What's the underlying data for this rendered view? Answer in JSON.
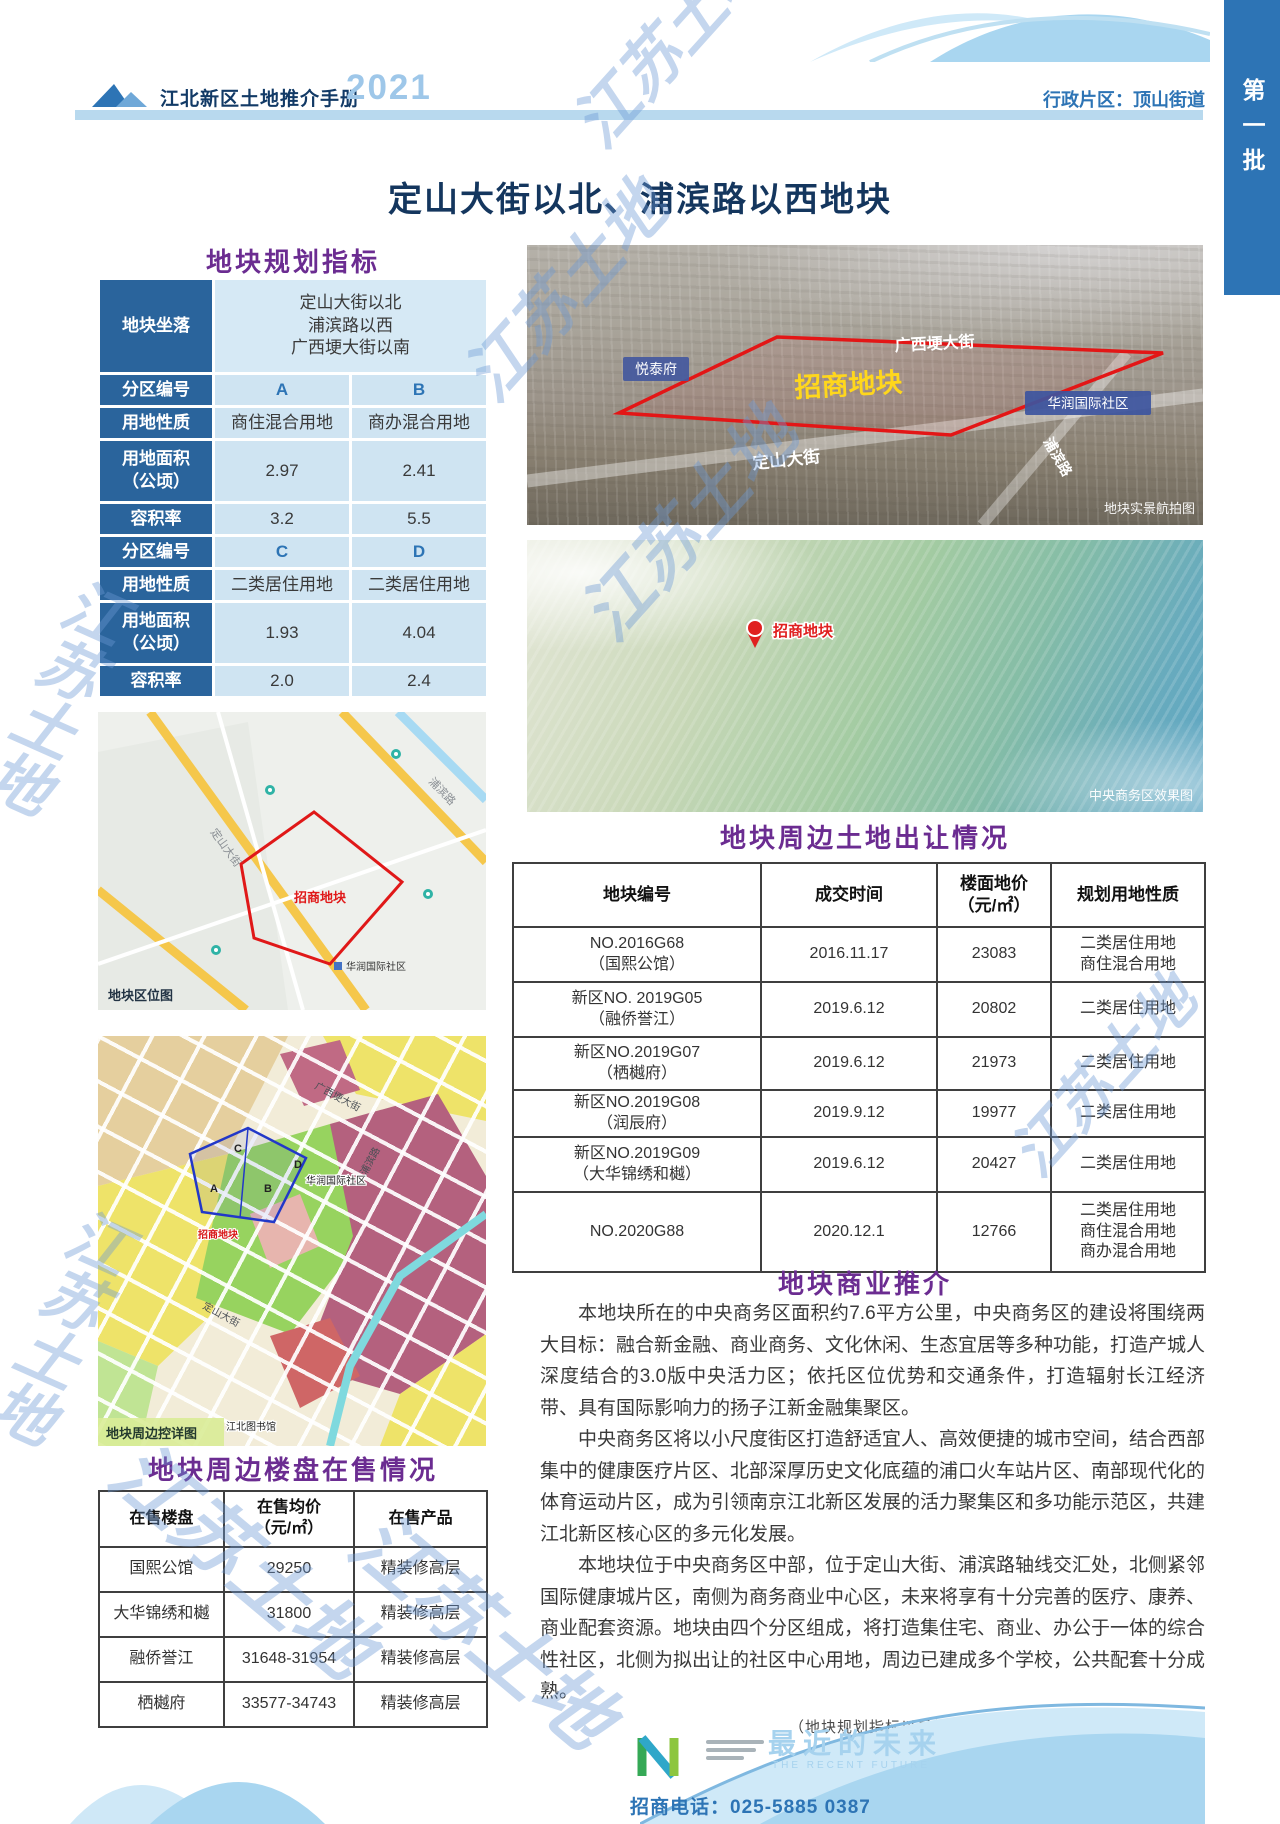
{
  "header": {
    "handbook_title": "江北新区土地推介手册",
    "year": "2021",
    "district_label": "行政片区：顶山街道",
    "batch_tab": "第一批"
  },
  "page_title": "定山大街以北、浦滨路以西地块",
  "watermark_text": "江苏土地",
  "colors": {
    "accent_blue": "#2d74b5",
    "title_purple": "#6b2c91",
    "table_header_blue": "#2a649c",
    "table_cell_blue": "#cfe4f2",
    "plot_outline_red": "#e01818"
  },
  "planning_table": {
    "title": "地块规划指标",
    "rows": [
      {
        "label": "地块坐落",
        "value": "定山大街以北\n浦滨路以西\n广西埂大街以南"
      },
      {
        "label": "分区编号",
        "a": "A",
        "b": "B"
      },
      {
        "label": "用地性质",
        "a": "商住混合用地",
        "b": "商办混合用地"
      },
      {
        "label": "用地面积\n（公顷）",
        "a": "2.97",
        "b": "2.41"
      },
      {
        "label": "容积率",
        "a": "3.2",
        "b": "5.5"
      },
      {
        "label": "分区编号",
        "a": "C",
        "b": "D"
      },
      {
        "label": "用地性质",
        "a": "二类居住用地",
        "b": "二类居住用地"
      },
      {
        "label": "用地面积\n（公顷）",
        "a": "1.93",
        "b": "4.04"
      },
      {
        "label": "容积率",
        "a": "2.0",
        "b": "2.4"
      }
    ]
  },
  "location_map": {
    "caption": "地块区位图",
    "plot_label": "招商地块",
    "labels": {
      "road1": "定山大街",
      "road2": "浦滨路",
      "community": "华润国际社区"
    }
  },
  "zoning_map": {
    "caption": "地块周边控详图",
    "plot_label": "招商地块",
    "zones": [
      "A",
      "B",
      "C",
      "D"
    ],
    "labels": {
      "road1": "广西埂大街",
      "road2": "浦滨路",
      "road3": "定山大街",
      "community": "华润国际社区",
      "library": "江北图书馆"
    }
  },
  "aerial_photo": {
    "caption": "地块实景航拍图",
    "plot_label": "招商地块",
    "labels": {
      "estate1": "悦泰府",
      "road1": "广西埂大街",
      "community": "华润国际社区",
      "road2": "定山大街",
      "road3": "浦滨路"
    }
  },
  "cbd_render": {
    "caption": "中央商务区效果图",
    "pin_label": "招商地块"
  },
  "land_sales_table": {
    "title": "地块周边土地出让情况",
    "headers": [
      "地块编号",
      "成交时间",
      "楼面地价\n（元/㎡）",
      "规划用地性质"
    ],
    "rows": [
      [
        "NO.2016G68\n（国熙公馆）",
        "2016.11.17",
        "23083",
        "二类居住用地\n商住混合用地"
      ],
      [
        "新区NO. 2019G05\n（融侨誉江）",
        "2019.6.12",
        "20802",
        "二类居住用地"
      ],
      [
        "新区NO.2019G07\n（栖樾府）",
        "2019.6.12",
        "21973",
        "二类居住用地"
      ],
      [
        "新区NO.2019G08\n（润辰府）",
        "2019.9.12",
        "19977",
        "二类居住用地"
      ],
      [
        "新区NO.2019G09\n（大华锦绣和樾）",
        "2019.6.12",
        "20427",
        "二类居住用地"
      ],
      [
        "NO.2020G88",
        "2020.12.1",
        "12766",
        "二类居住用地\n商住混合用地\n商办混合用地"
      ]
    ]
  },
  "promo": {
    "title": "地块商业推介",
    "paragraphs": [
      "本地块所在的中央商务区面积约7.6平方公里，中央商务区的建设将围绕两大目标：融合新金融、商业商务、文化休闲、生态宜居等多种功能，打造产城人深度结合的3.0版中央活力区；依托区位优势和交通条件，打造辐射长江经济带、具有国际影响力的扬子江新金融集聚区。",
      "中央商务区将以小尺度街区打造舒适宜人、高效便捷的城市空间，结合西部集中的健康医疗片区、北部深厚历史文化底蕴的浦口火车站片区、南部现代化的体育运动片区，成为引领南京江北新区发展的活力聚集区和多功能示范区，共建江北新区核心区的多元化发展。",
      "本地块位于中央商务区中部，位于定山大街、浦滨路轴线交汇处，北侧紧邻国际健康城片区，南侧为商务商业中心区，未来将享有十分完善的医疗、康养、商业配套资源。地块由四个分区组成，将打造集住宅、商业、办公于一体的综合性社区，北侧为拟出让的社区中心用地，周边已建成多个学校，公共配套十分成熟。"
    ],
    "footnote": "（地块规划指标以最终出让公告为准，在售房价仅供参考）"
  },
  "housing_table": {
    "title": "地块周边楼盘在售情况",
    "headers": [
      "在售楼盘",
      "在售均价\n（元/㎡）",
      "在售产品"
    ],
    "rows": [
      [
        "国熙公馆",
        "29250",
        "精装修高层"
      ],
      [
        "大华锦绣和樾",
        "31800",
        "精装修高层"
      ],
      [
        "融侨誉江",
        "31648-31954",
        "精装修高层"
      ],
      [
        "栖樾府",
        "33577-34743",
        "精装修高层"
      ]
    ]
  },
  "footer": {
    "slogan": "最近的未来",
    "slogan_en": "THE RECENT FUTURE",
    "phone": "招商电话：025-5885 0387"
  }
}
